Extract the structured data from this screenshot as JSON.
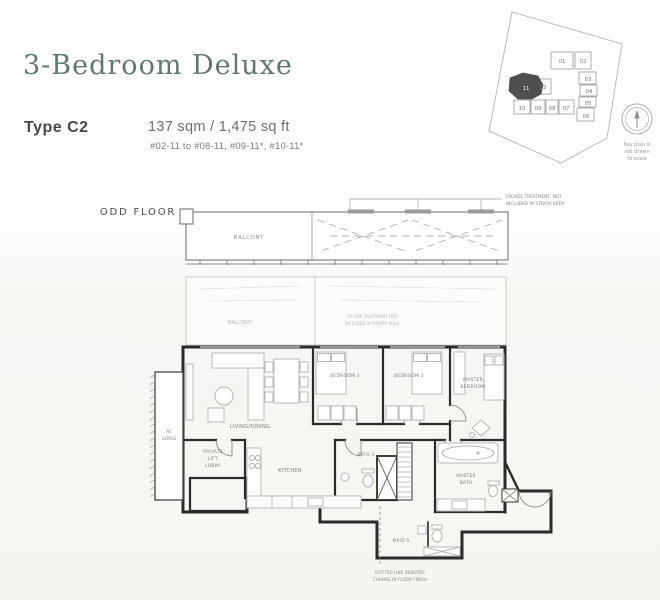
{
  "header": {
    "title": "3-Bedroom Deluxe",
    "type_label": "Type C2",
    "area": "137 sqm / 1,475 sq ft",
    "unit_range": "#02-11 to #08-11, #09-11*, #10-11*"
  },
  "key_plan": {
    "units": [
      "01",
      "02",
      "03",
      "04",
      "05",
      "06",
      "07",
      "08",
      "09",
      "10",
      "11",
      "12"
    ],
    "highlighted_unit": "11",
    "compass_label": "N",
    "note_lines": [
      "Key plan is",
      "not drawn",
      "to scale"
    ]
  },
  "floor_plan": {
    "floor_label": "ODD FLOOR",
    "balcony_label": "BALCONY",
    "facade_note_lines": [
      "FACADE TREATMENT, NOT",
      "INCLUDED IN STRATA AREA"
    ],
    "inner_balcony_label": "BALCONY",
    "inner_facade_lines": [
      "FACADE TREATMENT NOT",
      "INCLUDED IN STRATA AREA"
    ],
    "rooms": {
      "living_dining": "LIVING/DINING",
      "bedroom_3": "BEDROOM 3",
      "bedroom_2": "BEDROOM 2",
      "master_bedroom_lines": [
        "MASTER",
        "BEDROOM"
      ],
      "kitchen": "KITCHEN",
      "bath_2": "BATH 2",
      "master_bath_lines": [
        "MASTER",
        "BATH"
      ],
      "private_lift_lobby_lines": [
        "PRIVATE",
        "LIFT",
        "LOBBY"
      ],
      "ac_ledge_lines": [
        "AC",
        "LEDGE"
      ],
      "maids_room": "MAID'S"
    },
    "bottom_note_lines": [
      "DOTTED LINE DENOTES",
      "CHANGE IN FLOOR FINISH"
    ]
  },
  "colors": {
    "title_green": "#60796c",
    "heading_dark": "#45494a",
    "body_gray": "#6e6e6e",
    "wall_dark": "#2b2b2b",
    "light_line": "#b8b8b6",
    "keyplan_highlight": "#4f4f4f"
  }
}
